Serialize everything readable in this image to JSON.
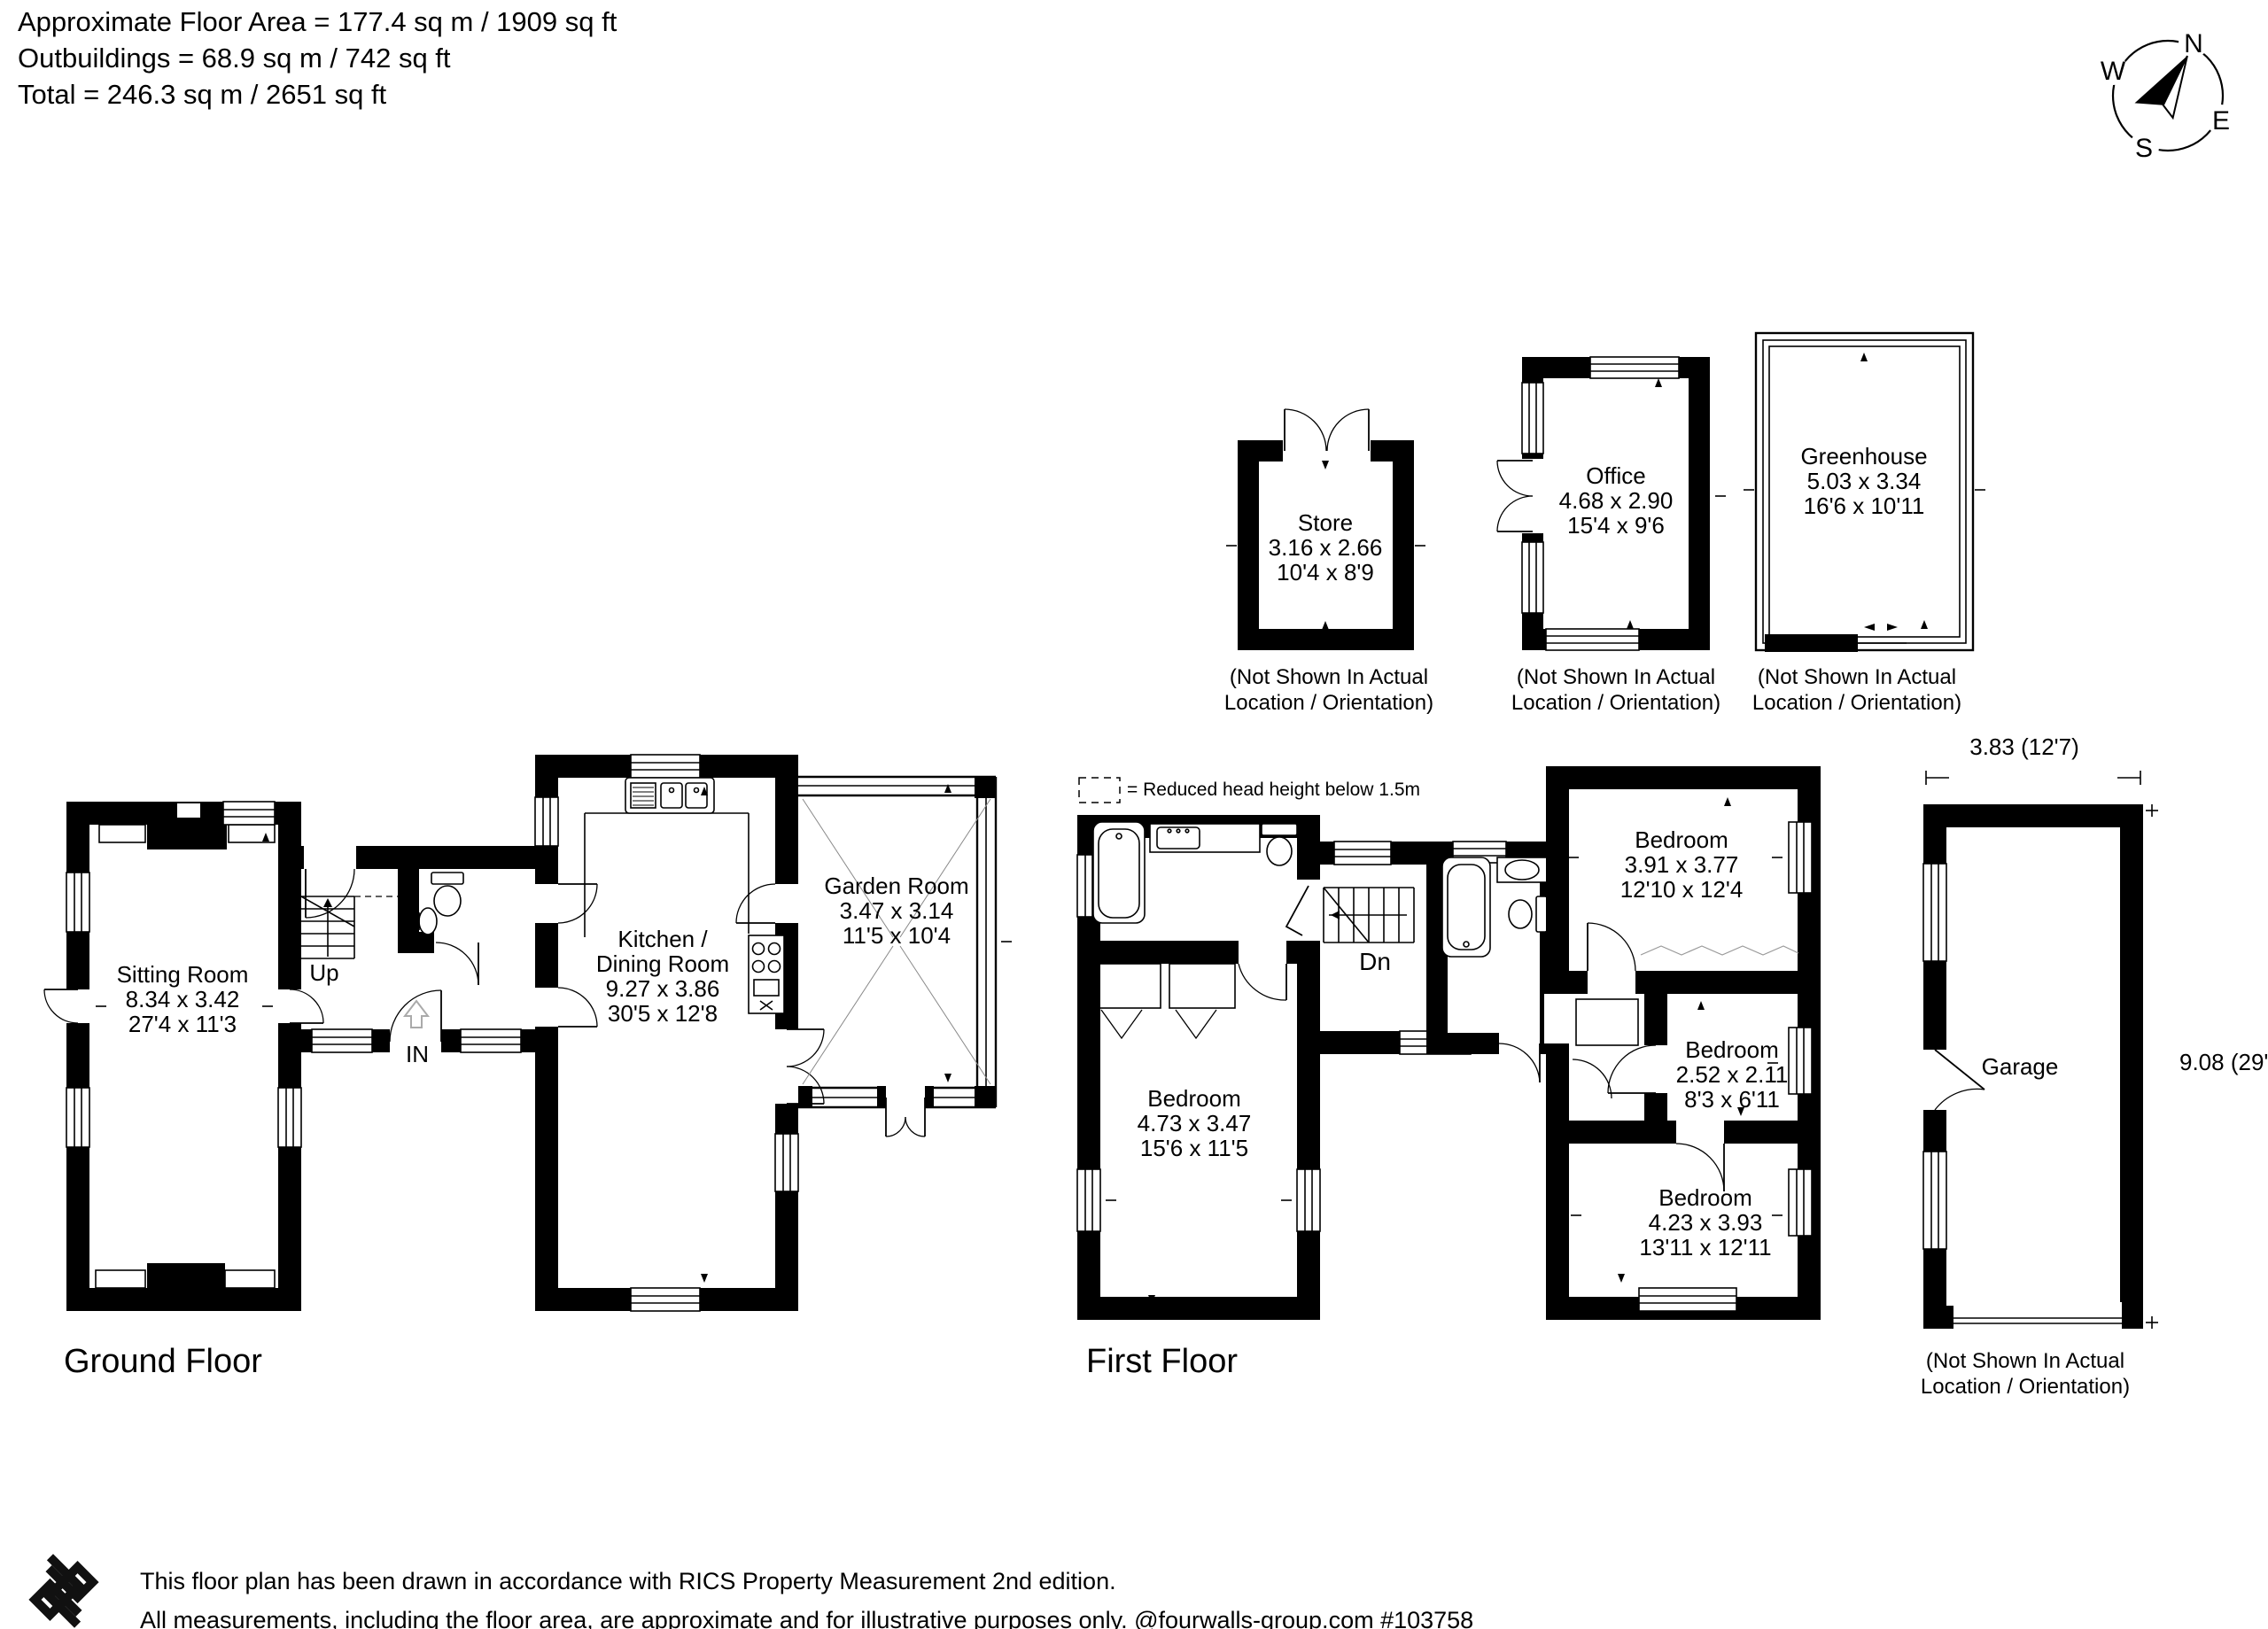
{
  "header": {
    "line1": "Approximate Floor Area = 177.4 sq m / 1909 sq ft",
    "line2": "Outbuildings = 68.9 sq m / 742 sq ft",
    "line3": "Total = 246.3 sq m / 2651 sq ft"
  },
  "compass": {
    "north": "N",
    "east": "E",
    "south": "S",
    "west": "W"
  },
  "outbuildings": {
    "store": {
      "name": "Store",
      "metric": "3.16 x 2.66",
      "imperial": "10'4 x 8'9",
      "note_line1": "(Not Shown In Actual",
      "note_line2": "Location / Orientation)"
    },
    "office": {
      "name": "Office",
      "metric": "4.68 x 2.90",
      "imperial": "15'4 x 9'6",
      "note_line1": "(Not Shown In Actual",
      "note_line2": "Location / Orientation)"
    },
    "greenhouse": {
      "name": "Greenhouse",
      "metric": "5.03 x 3.34",
      "imperial": "16'6 x 10'11",
      "note_line1": "(Not Shown In Actual",
      "note_line2": "Location / Orientation)"
    }
  },
  "ground_floor": {
    "label": "Ground Floor",
    "stairs": "Up",
    "entrance": "IN",
    "sitting_room": {
      "name": "Sitting Room",
      "metric": "8.34 x 3.42",
      "imperial": "27'4 x 11'3"
    },
    "kitchen": {
      "name_line1": "Kitchen /",
      "name_line2": "Dining Room",
      "metric": "9.27 x 3.86",
      "imperial": "30'5 x 12'8"
    },
    "garden_room": {
      "name": "Garden Room",
      "metric": "3.47 x 3.14",
      "imperial": "11'5 x 10'4"
    }
  },
  "first_floor": {
    "label": "First Floor",
    "legend": "= Reduced head height below 1.5m",
    "stairs": "Dn",
    "bedroom_1": {
      "name": "Bedroom",
      "metric": "4.73 x 3.47",
      "imperial": "15'6 x 11'5"
    },
    "bedroom_2": {
      "name": "Bedroom",
      "metric": "3.91 x 3.77",
      "imperial": "12'10 x 12'4"
    },
    "bedroom_3": {
      "name": "Bedroom",
      "metric": "2.52 x 2.11",
      "imperial": "8'3 x 6'11"
    },
    "bedroom_4": {
      "name": "Bedroom",
      "metric": "4.23 x 3.93",
      "imperial": "13'11 x 12'11"
    }
  },
  "garage": {
    "name": "Garage",
    "width_dim": "3.83 (12'7)",
    "depth_dim": "9.08 (29'9)",
    "note_line1": "(Not Shown In Actual",
    "note_line2": "Location / Orientation)"
  },
  "footer": {
    "line1": "This floor plan has been drawn in accordance with RICS Property Measurement 2nd edition.",
    "line2": "All measurements, including the floor area, are approximate and for illustrative purposes only. @fourwalls-group.com #103758"
  }
}
